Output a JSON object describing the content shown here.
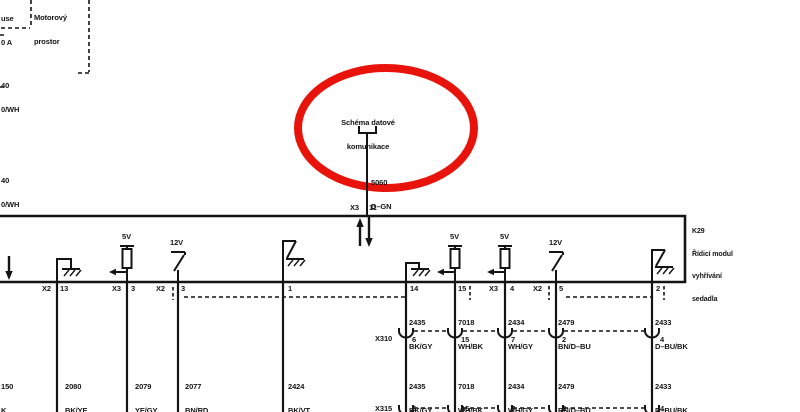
{
  "accent_red": "#e8140c",
  "fuse_box": {
    "line1": "use",
    "line2": "0 A"
  },
  "compartment_label": {
    "line1": "Motorový",
    "line2": "prostor"
  },
  "left_wire_labels": [
    {
      "circuit": "40",
      "color": "0/WH"
    },
    {
      "circuit": "40",
      "color": "0/WH"
    }
  ],
  "callout": {
    "title_line1": "Schéma datové",
    "title_line2": "komunikace",
    "wire_circuit": "5060",
    "wire_color": "D–GN"
  },
  "bus_pin": {
    "connector": "X3",
    "pin": "11"
  },
  "module": {
    "id": "K29",
    "name_line1": "Řídicí modul",
    "name_line2": "vyhřívání",
    "name_line3": "sedadla"
  },
  "supply_labels": {
    "res1": "5V",
    "sw1": "12V",
    "res2": "5V",
    "res3": "5V",
    "sw2": "12V"
  },
  "module_pins": [
    {
      "connector": "X2",
      "pin": "13"
    },
    {
      "connector": "X3",
      "pin": "3"
    },
    {
      "connector": "X2",
      "pin": "3"
    },
    {
      "connector": "",
      "pin": "1"
    },
    {
      "connector": "",
      "pin": "14"
    },
    {
      "connector": "",
      "pin": "15"
    },
    {
      "connector": "X3",
      "pin": "4"
    },
    {
      "connector": "X2",
      "pin": "5"
    },
    {
      "connector": "",
      "pin": "2"
    }
  ],
  "wire_labels_row1": [
    {
      "circuit": "2435",
      "color": "BK/GY"
    },
    {
      "circuit": "7018",
      "color": "WH/BK"
    },
    {
      "circuit": "2434",
      "color": "WH/GY"
    },
    {
      "circuit": "2479",
      "color": "BN/D–BU"
    },
    {
      "circuit": "2433",
      "color": "D–BU/BK"
    }
  ],
  "connector_x310": {
    "label": "X310",
    "pins": [
      "6",
      "15",
      "7",
      "2",
      "4"
    ]
  },
  "wire_labels_row2_left": [
    {
      "circuit": "150",
      "color": "K"
    },
    {
      "circuit": "2080",
      "color": "BK/YE"
    },
    {
      "circuit": "2079",
      "color": "YE/GY"
    },
    {
      "circuit": "2077",
      "color": "BN/RD"
    },
    {
      "circuit": "2424",
      "color": "BK/VT"
    }
  ],
  "wire_labels_row2_right": [
    {
      "circuit": "2435",
      "color": "BK/GY"
    },
    {
      "circuit": "7018",
      "color": "WH/BK"
    },
    {
      "circuit": "2434",
      "color": "WH/GY"
    },
    {
      "circuit": "2479",
      "color": "BN/D–BU"
    },
    {
      "circuit": "2433",
      "color": "D–BU/BK"
    }
  ],
  "connector_x315": {
    "label": "X315",
    "pins": [
      "6",
      "15",
      "7",
      "2",
      "4"
    ]
  }
}
